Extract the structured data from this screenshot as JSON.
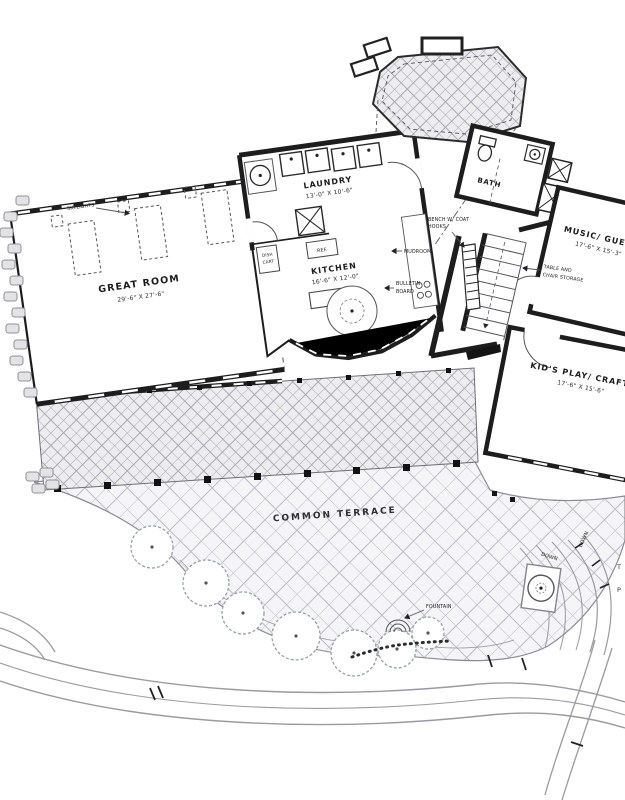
{
  "plan": {
    "title": "First floor plan drawing",
    "rooms": {
      "great_room": {
        "name": "GREAT ROOM",
        "dims": "29'-6\" X 27'-6\""
      },
      "laundry": {
        "name": "LAUNDRY",
        "dims": "13'-0\" X 10'-6\""
      },
      "kitchen": {
        "name": "KITCHEN",
        "dims": "16'-6\" X 12'-0\""
      },
      "bath": {
        "name": "BATH"
      },
      "music_guest": {
        "name": "MUSIC/ GUEST",
        "dims": "17'-6\" X 15'-3\""
      },
      "kids_play": {
        "name": "KID'S PLAY/ CRAFTS",
        "dims": "17'-6\" X 15'-6\""
      },
      "terrace": {
        "name": "COMMON TERRACE"
      }
    },
    "annotations": {
      "skylights": "SKYLIGHTS",
      "bench_line1": "BENCH W/ COAT",
      "bench_line2": "HOOKS",
      "mudroom": "MUDROOM",
      "bulletin_line1": "BULLETIN",
      "bulletin_line2": "BOARD",
      "dish_line1": "DISH",
      "dish_line2": "CART",
      "ref": "REF.",
      "storage_line1": "TABLE AND",
      "storage_line2": "CHAIR STORAGE",
      "fountain": "FOUNTAIN",
      "down_a": "DOWN",
      "down_b": "DOWN",
      "edge_t": "T",
      "edge_p": "P"
    },
    "colors": {
      "ink": "#1d1d1d",
      "hatch_light": "#bcbcc6",
      "hatch_dark": "#a9a9b4",
      "paper": "#ffffff"
    }
  }
}
